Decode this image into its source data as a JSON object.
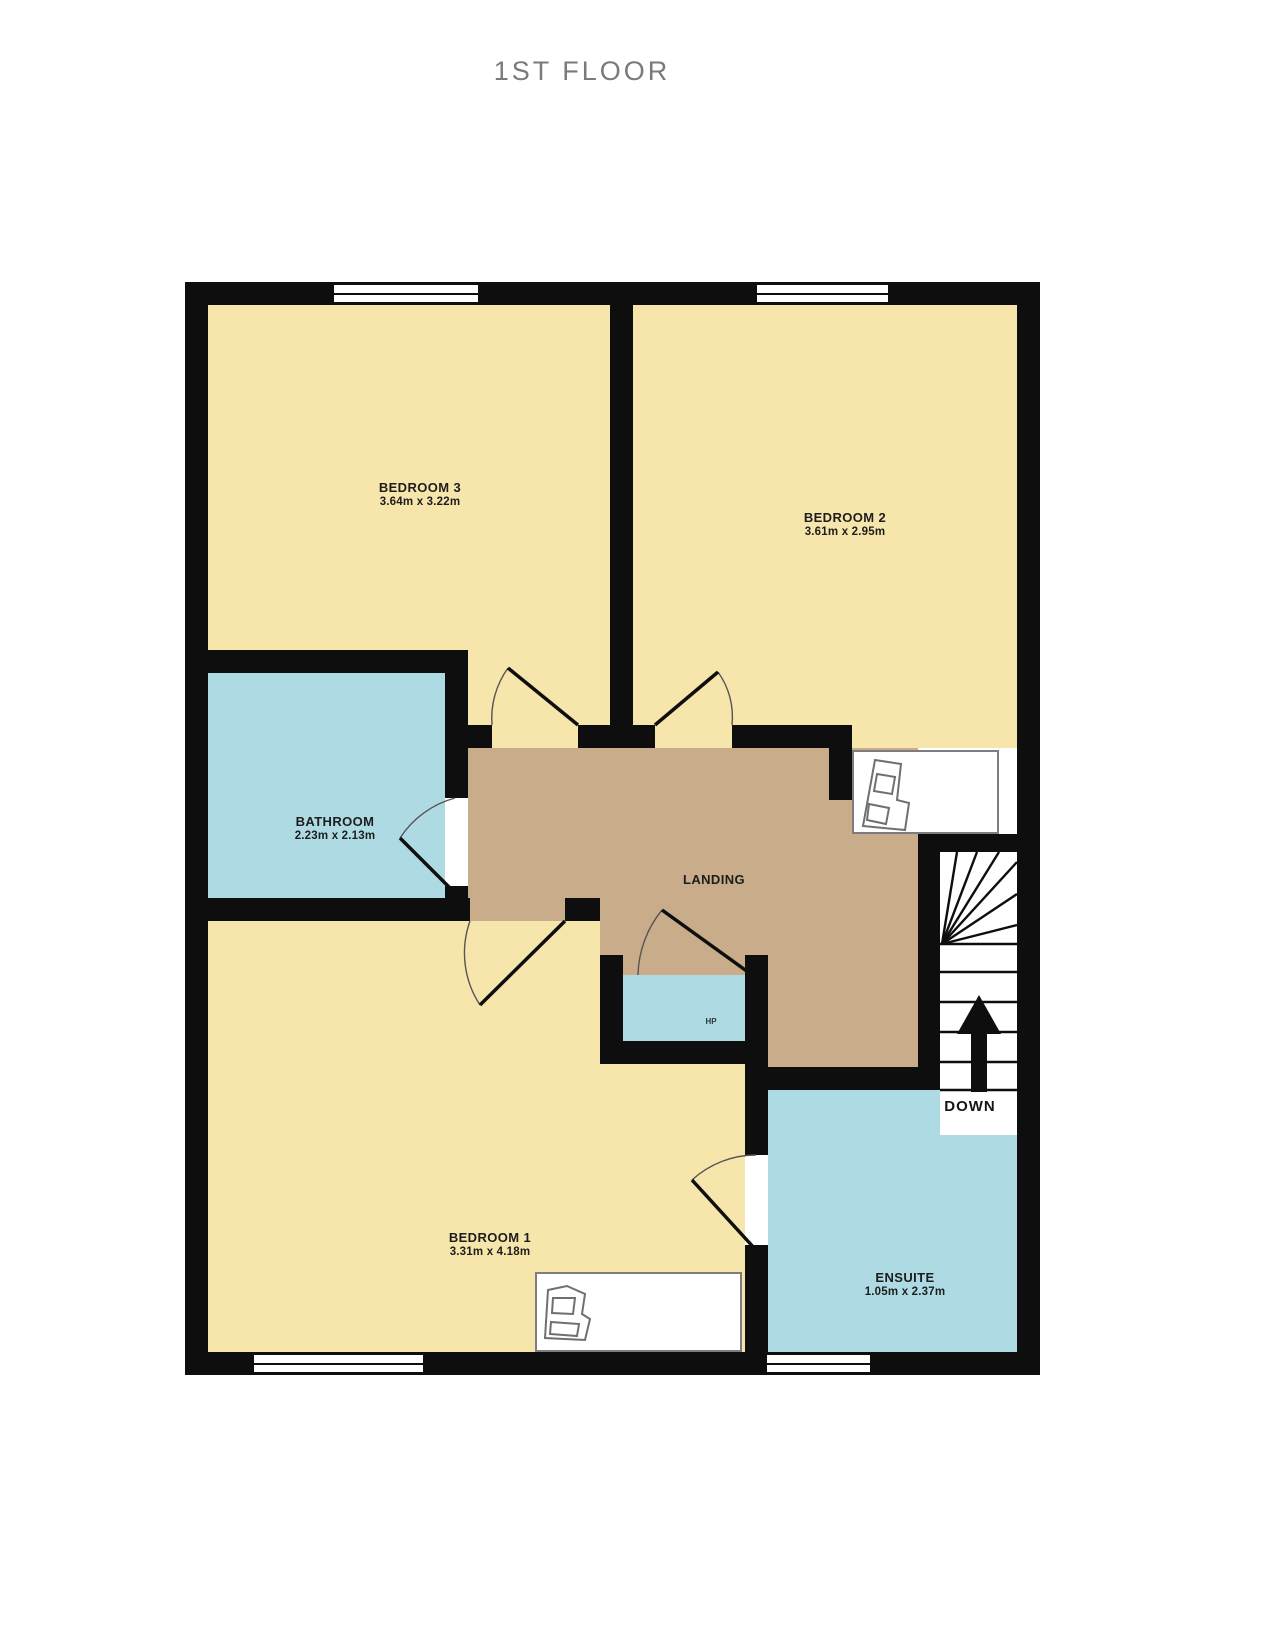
{
  "title": "1ST FLOOR",
  "rooms": {
    "bedroom3": {
      "name": "BEDROOM 3",
      "dims": "3.64m x 3.22m"
    },
    "bedroom2": {
      "name": "BEDROOM 2",
      "dims": "3.61m x 2.95m"
    },
    "bathroom": {
      "name": "BATHROOM",
      "dims": "2.23m x 2.13m"
    },
    "landing": {
      "name": "LANDING"
    },
    "bedroom1": {
      "name": "BEDROOM 1",
      "dims": "3.31m x 4.18m"
    },
    "ensuite": {
      "name": "ENSUITE",
      "dims": "1.05m x 2.37m"
    },
    "closet": {
      "name": "HP"
    }
  },
  "stairs": {
    "label": "DOWN"
  },
  "colors": {
    "bedroom_yellow": "#f6e6ab",
    "wet_room_blue": "#aedbe3",
    "landing_tan": "#c9ad8a",
    "wall_black": "#0e0e0e",
    "title_gray": "#7a7a7a"
  }
}
